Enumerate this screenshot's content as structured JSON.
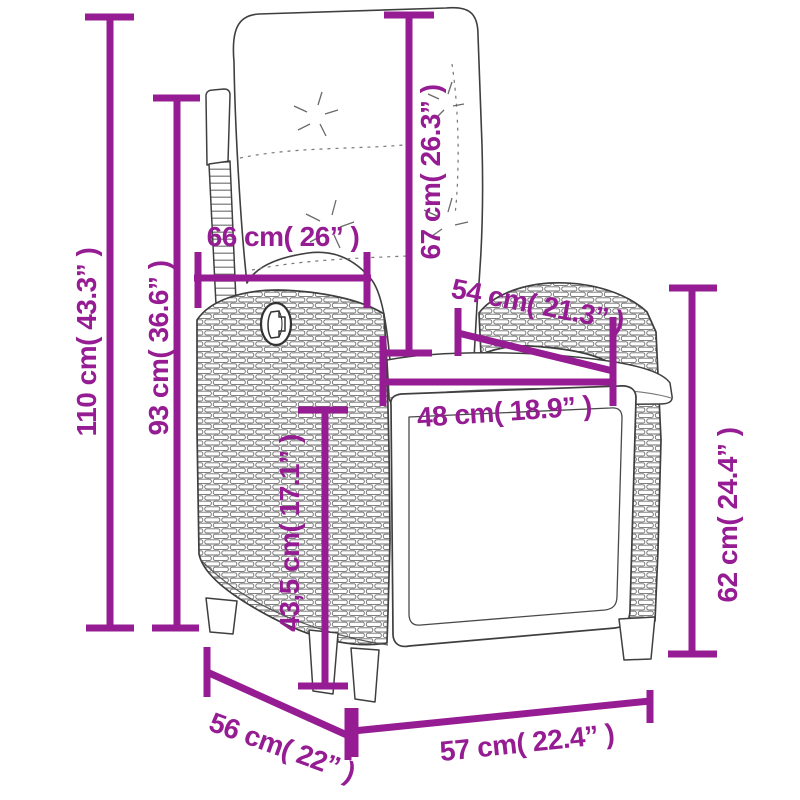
{
  "page": {
    "background": "#ffffff"
  },
  "diagram": {
    "type": "product-dimension-diagram",
    "subject": "reclining rattan garden chair with cushions"
  },
  "colors": {
    "accent": "#951c92",
    "outline": "#3f3f3f",
    "wicker": "#6e6e6e"
  },
  "dimensions": {
    "total_height": {
      "label": "110 cm( 43.3” )"
    },
    "back_height": {
      "label": "93 cm( 36.6” )"
    },
    "back_width": {
      "label": "66 cm( 26” )"
    },
    "backrest_length": {
      "label": "67 cm( 26.3” )"
    },
    "armrest_length": {
      "label": "54 cm( 21.3” )"
    },
    "seat_width": {
      "label": "48 cm( 18.9” )"
    },
    "seat_height": {
      "label": "43,5 cm( 17.1” )"
    },
    "armrest_height": {
      "label": "62 cm( 24.4” )"
    },
    "depth": {
      "label": "56 cm( 22” )"
    },
    "width": {
      "label": "57 cm( 22.4” )"
    }
  }
}
